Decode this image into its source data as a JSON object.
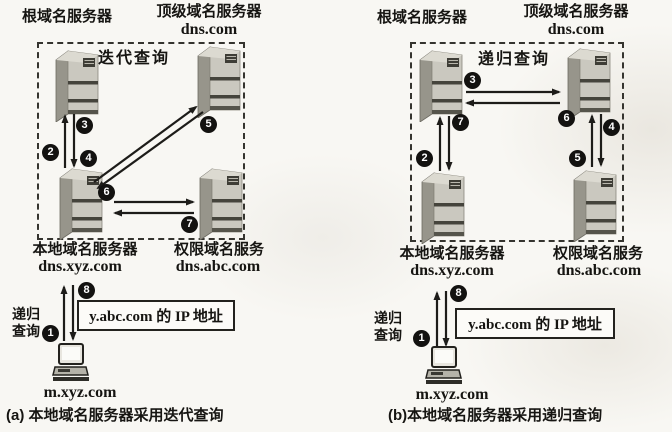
{
  "colors": {
    "background": "#f8f7f3",
    "arrow": "#1d1c19",
    "badge": "#131210",
    "dashed_border": "#35342f",
    "server_front": "#cac8bf",
    "server_side": "#97958b",
    "ip_box_bg": "#fcfbf8"
  },
  "panel_a": {
    "root_server_label": "根域名服务器",
    "tld_server_label": "顶级域名服务器",
    "tld_server_domain": "dns.com",
    "query_mode_label": "迭代查询",
    "local_server_label": "本地域名服务器",
    "local_server_domain": "dns.xyz.com",
    "auth_server_label": "权限域名服务",
    "auth_server_domain": "dns.abc.com",
    "recursive_note_line1": "递归",
    "recursive_note_line2": "查询",
    "ip_result_label": "y.abc.com 的 IP 地址",
    "host_label": "m.xyz.com",
    "caption": "(a) 本地域名服务器采用迭代查询",
    "steps": {
      "s1": "1",
      "s2": "2",
      "s3": "3",
      "s4": "4",
      "s5": "5",
      "s6": "6",
      "s7": "7",
      "s8": "8"
    }
  },
  "panel_b": {
    "root_server_label": "根域名服务器",
    "tld_server_label": "顶级域名服务器",
    "tld_server_domain": "dns.com",
    "query_mode_label": "递归查询",
    "local_server_label": "本地域名服务器",
    "local_server_domain": "dns.xyz.com",
    "auth_server_label": "权限域名服务",
    "auth_server_domain": "dns.abc.com",
    "recursive_note_line1": "递归",
    "recursive_note_line2": "查询",
    "ip_result_label": "y.abc.com 的 IP 地址",
    "host_label": "m.xyz.com",
    "caption": "(b)本地域名服务器采用递归查询",
    "steps": {
      "s1": "1",
      "s2": "2",
      "s3": "3",
      "s4": "4",
      "s5": "5",
      "s6": "6",
      "s7": "7",
      "s8": "8"
    }
  }
}
